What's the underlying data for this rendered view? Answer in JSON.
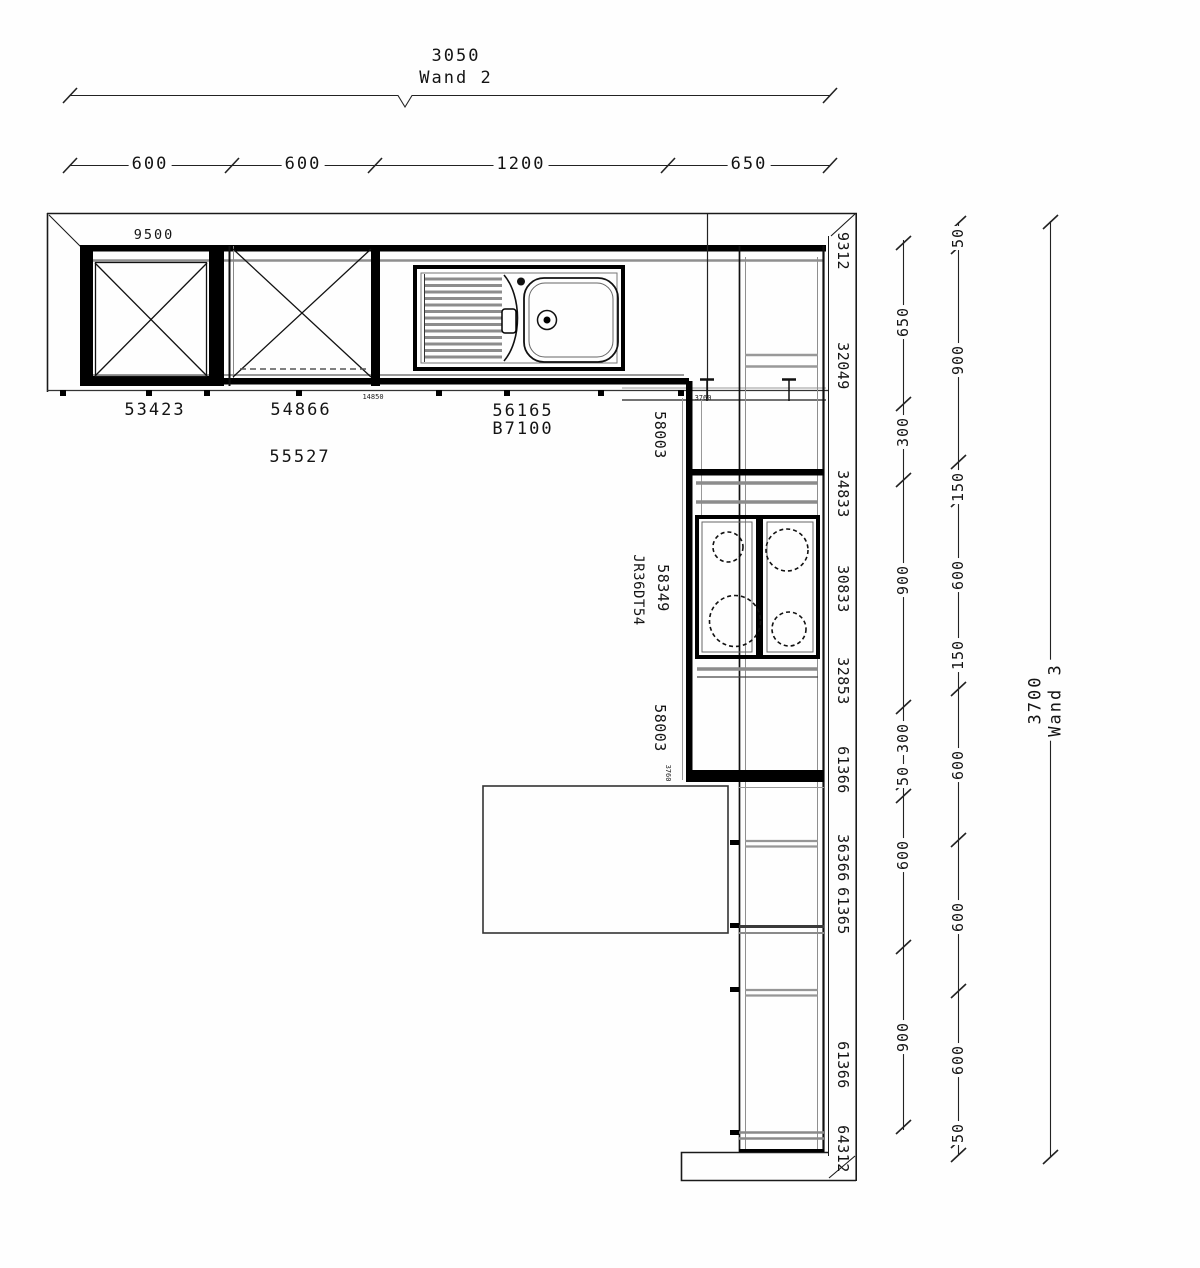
{
  "document": {
    "type": "kitchen floor plan"
  },
  "wand2": {
    "total": "3050",
    "label": "Wand 2",
    "segments": [
      "600",
      "600",
      "1200",
      "650"
    ]
  },
  "wand3": {
    "total": "3700",
    "label": "Wand 3",
    "inner_segments": [
      "650",
      "300",
      "900",
      "300",
      "50",
      "600",
      "900"
    ],
    "outer_segments": [
      "50",
      "900",
      "150",
      "600",
      "150",
      "600",
      "600",
      "600",
      "50"
    ]
  },
  "codes": {
    "wall_unit": "9500",
    "base1": "53423",
    "base2": "54866",
    "base2b": "55527",
    "sink_a": "56165",
    "sink_b": "B7100",
    "corner_a": "58003",
    "corner_b": "58349",
    "corner_c": "JR36DT54",
    "corner_d": "58003",
    "column": [
      "9312",
      "32049",
      "34833",
      "30833",
      "32853",
      "61366",
      "36366",
      "61365",
      "61366",
      "64312"
    ],
    "tiny_a": "14850",
    "tiny_b": "3760",
    "tiny_c": "3760"
  },
  "colors": {
    "line": "#000000",
    "gray": "#8f8f8f",
    "background": "#fefefe"
  }
}
